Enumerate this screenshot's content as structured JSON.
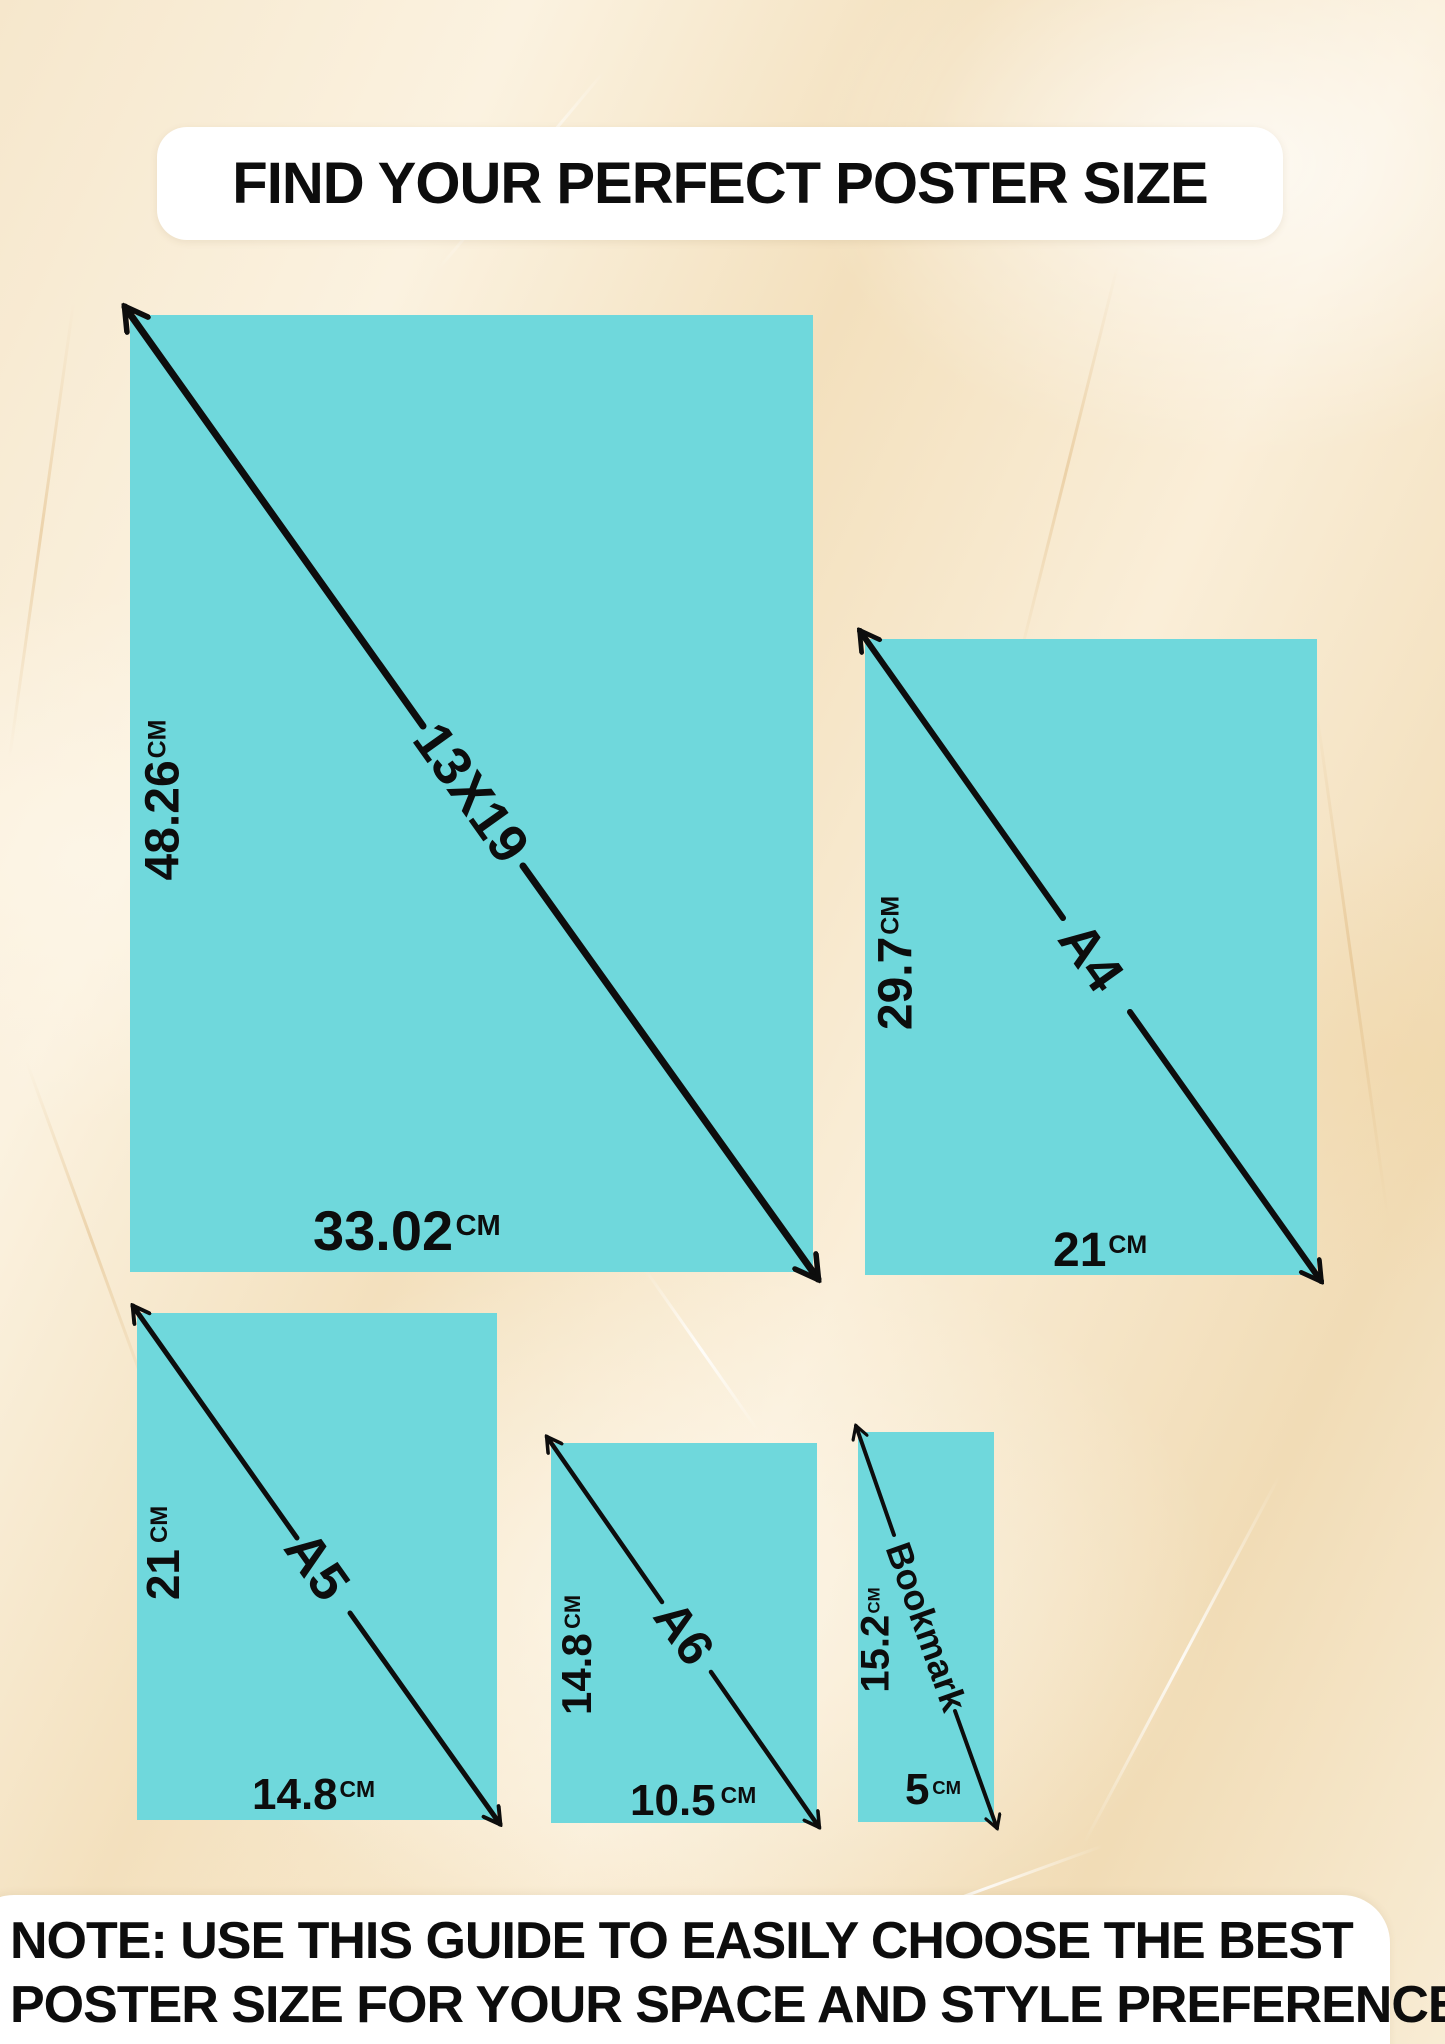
{
  "title": "FIND YOUR PERFECT POSTER SIZE",
  "note": {
    "line1": "NOTE: USE THIS GUIDE TO EASILY CHOOSE THE BEST",
    "line2": "POSTER SIZE FOR YOUR SPACE AND STYLE PREFERENCES"
  },
  "colors": {
    "panel_teal": "#6fd8dc",
    "arrow_black": "#0d0d0d",
    "background_cream": "#f7e9d0",
    "card_white": "#ffffff",
    "text_black": "#0d0d0d"
  },
  "posters": [
    {
      "name": "13X19",
      "height_value": "48.26",
      "height_unit": "CM",
      "width_value": "33.02",
      "width_unit": "CM"
    },
    {
      "name": "A4",
      "height_value": "29.7",
      "height_unit": "CM",
      "width_value": "21",
      "width_unit": "CM"
    },
    {
      "name": "A5",
      "height_value": "21",
      "height_unit": "CM",
      "width_value": "14.8",
      "width_unit": "CM"
    },
    {
      "name": "A6",
      "height_value": "14.8",
      "height_unit": "CM",
      "width_value": "10.5",
      "width_unit": "CM"
    },
    {
      "name": "Bookmark",
      "height_value": "15.2",
      "height_unit": "CM",
      "width_value": "5",
      "width_unit": "CM"
    }
  ]
}
